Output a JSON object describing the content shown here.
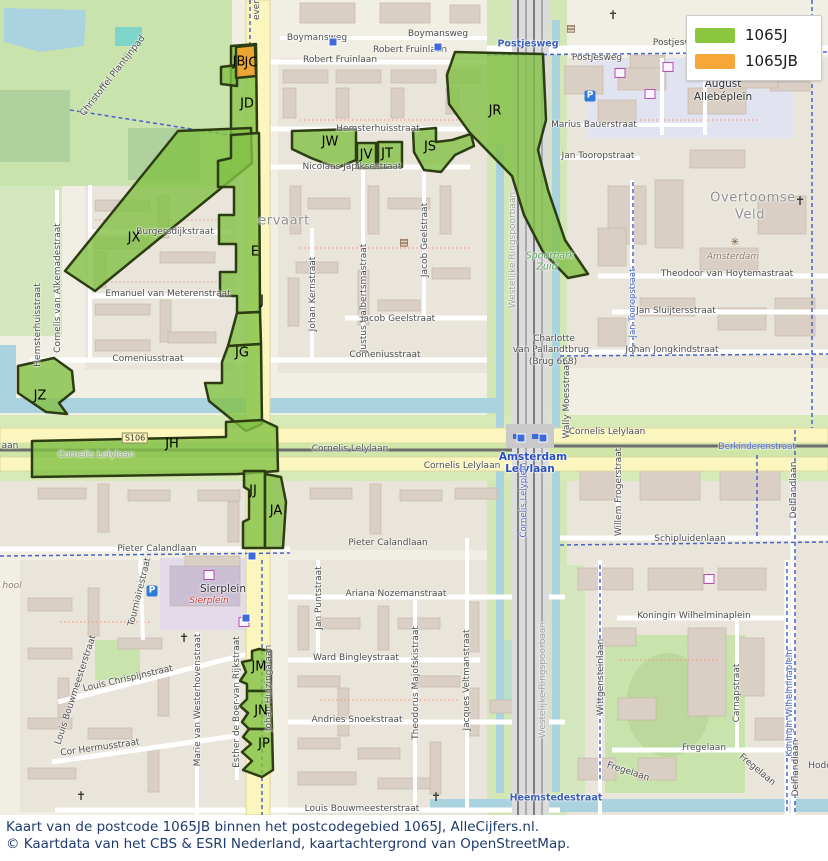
{
  "legend": {
    "items": [
      {
        "label": "1065J",
        "color": "#8cc63f"
      },
      {
        "label": "1065JB",
        "color": "#f7a738"
      }
    ]
  },
  "caption": {
    "line1": "Kaart van de postcode 1065JB binnen het postcodegebied 1065J, AlleCijfers.nl.",
    "line2": "© Kaartdata van het CBS & ESRI Nederland, kaartachtergrond van OpenStreetMap."
  },
  "colors": {
    "area_fill": "#82c045",
    "area_highlight_fill": "#f0a22e",
    "area_border": "#2c3d12",
    "water": "#aad3df",
    "park": "#c9e3ac",
    "road_yellow": "#fbf6bd",
    "caption_text": "#1e3c6e"
  },
  "map": {
    "area_code_labels": [
      {
        "text": "JB",
        "x": 239,
        "y": 62
      },
      {
        "text": "JC",
        "x": 251,
        "y": 63
      },
      {
        "text": "JD",
        "x": 247,
        "y": 104
      },
      {
        "text": "JX",
        "x": 134,
        "y": 238
      },
      {
        "text": "E",
        "x": 255,
        "y": 252
      },
      {
        "text": "J",
        "x": 262,
        "y": 301
      },
      {
        "text": "JG",
        "x": 242,
        "y": 353
      },
      {
        "text": "JZ",
        "x": 40,
        "y": 396
      },
      {
        "text": "JH",
        "x": 172,
        "y": 444
      },
      {
        "text": "JJ",
        "x": 253,
        "y": 491
      },
      {
        "text": "JA",
        "x": 276,
        "y": 511
      },
      {
        "text": "JR",
        "x": 495,
        "y": 111
      },
      {
        "text": "JW",
        "x": 330,
        "y": 142
      },
      {
        "text": "JV",
        "x": 366,
        "y": 155
      },
      {
        "text": "JT",
        "x": 387,
        "y": 154
      },
      {
        "text": "JS",
        "x": 430,
        "y": 147
      },
      {
        "text": "JM",
        "x": 259,
        "y": 667
      },
      {
        "text": "JN",
        "x": 261,
        "y": 711
      },
      {
        "text": "JP",
        "x": 264,
        "y": 744
      }
    ],
    "labels": [
      {
        "text": "ever",
        "x": 257,
        "y": 10,
        "rot": -90
      },
      {
        "text": "Boymansweg",
        "x": 317,
        "y": 38
      },
      {
        "text": "Boymansweg",
        "x": 438,
        "y": 34
      },
      {
        "text": "Robert Fruinlaan",
        "x": 410,
        "y": 50
      },
      {
        "text": "Robert Fruinlaan",
        "x": 340,
        "y": 60
      },
      {
        "text": "Postjesweg",
        "x": 528,
        "y": 44,
        "cls": "st-blue"
      },
      {
        "text": "Postjesweg",
        "x": 597,
        "y": 58
      },
      {
        "text": "Postjesweg",
        "x": 678,
        "y": 43
      },
      {
        "text": "F",
        "x": 810,
        "y": 29,
        "cls": "st-blue"
      },
      {
        "text": "August",
        "x": 723,
        "y": 84,
        "cls": "place-sm"
      },
      {
        "text": "Allebéplein",
        "x": 723,
        "y": 97,
        "cls": "place-sm"
      },
      {
        "text": "Marius Bauerstraat",
        "x": 594,
        "y": 125
      },
      {
        "text": "Jan Tooropstraat",
        "x": 598,
        "y": 156
      },
      {
        "text": "Overtoomse",
        "x": 753,
        "y": 198,
        "cls": "place"
      },
      {
        "text": "Veld",
        "x": 750,
        "y": 215,
        "cls": "place"
      },
      {
        "text": "Amsterdam",
        "x": 733,
        "y": 257,
        "cls": "place-brown"
      },
      {
        "text": "Theodoor van Hoytemastraat",
        "x": 727,
        "y": 274
      },
      {
        "text": "Jan Sluijtersstraat",
        "x": 676,
        "y": 311
      },
      {
        "text": "Johan Jongkindstraat",
        "x": 672,
        "y": 350
      },
      {
        "text": "Jan Tooropstraat",
        "x": 633,
        "y": 303,
        "rot": -90,
        "cls": "st-blue-sm"
      },
      {
        "text": "Hemsterhuisstraat",
        "x": 378,
        "y": 129
      },
      {
        "text": "Nicolaas Japiksestraat",
        "x": 352,
        "y": 167
      },
      {
        "text": "ervaart",
        "x": 284,
        "y": 221,
        "cls": "place"
      },
      {
        "text": "Burgersdijkstraat",
        "x": 175,
        "y": 232
      },
      {
        "text": "Emanuel van Meterenstraat",
        "x": 168,
        "y": 294
      },
      {
        "text": "Comeniusstraat",
        "x": 148,
        "y": 359
      },
      {
        "text": "Comeniusstraat",
        "x": 385,
        "y": 355
      },
      {
        "text": "Jacob Geelstraat",
        "x": 398,
        "y": 319
      },
      {
        "text": "Johan Kernstraat",
        "x": 313,
        "y": 294,
        "rot": -90
      },
      {
        "text": "Justus Halbertsmastraat",
        "x": 364,
        "y": 298,
        "rot": -90
      },
      {
        "text": "Jacob Geelstraat",
        "x": 425,
        "y": 240,
        "rot": -90
      },
      {
        "text": "Cornelis van Alkemadestraat",
        "x": 58,
        "y": 288,
        "rot": -90
      },
      {
        "text": "Hemsterhuisstraat",
        "x": 38,
        "y": 325,
        "rot": -90
      },
      {
        "text": "Christoffel Plantijnpad",
        "x": 113,
        "y": 76,
        "rot": -52
      },
      {
        "text": "Westelijke Ringspoorbaan",
        "x": 513,
        "y": 250,
        "rot": -90,
        "cls": "st-faded"
      },
      {
        "text": "Spoorpark",
        "x": 550,
        "y": 256,
        "cls": "park-lbl"
      },
      {
        "text": "Zuid",
        "x": 547,
        "y": 267,
        "cls": "park-lbl"
      },
      {
        "text": "Charlotte",
        "x": 554,
        "y": 339
      },
      {
        "text": "van Pallandtbrug",
        "x": 551,
        "y": 350
      },
      {
        "text": "(Brug 668)",
        "x": 553,
        "y": 362
      },
      {
        "text": "Wally Moesstraat",
        "x": 567,
        "y": 400,
        "rot": -90
      },
      {
        "text": "aan",
        "x": 10,
        "y": 446
      },
      {
        "text": "S106",
        "x": 135,
        "y": 438,
        "cls": "shield"
      },
      {
        "text": "Cornelis Lelylaan",
        "x": 96,
        "y": 455,
        "cls": "st-faded"
      },
      {
        "text": "Cornelis Lelylaan",
        "x": 350,
        "y": 449
      },
      {
        "text": "Cornelis Lelylaan",
        "x": 462,
        "y": 466
      },
      {
        "text": "Cornelis Lelylaan",
        "x": 607,
        "y": 432
      },
      {
        "text": "Amsterdam",
        "x": 533,
        "y": 457,
        "cls": "station"
      },
      {
        "text": "Lelylaan",
        "x": 530,
        "y": 469,
        "cls": "station"
      },
      {
        "text": "Cornelis Lelyplein",
        "x": 524,
        "y": 500,
        "rot": -90,
        "cls": "st-blue-sm"
      },
      {
        "text": "Derkinderenstraat",
        "x": 757,
        "y": 447,
        "cls": "st-blue-sm"
      },
      {
        "text": "Willem Frogerstraat",
        "x": 619,
        "y": 492,
        "rot": -90
      },
      {
        "text": "Delflandlaan",
        "x": 794,
        "y": 490,
        "rot": -90
      },
      {
        "text": "Schipluidenlaan",
        "x": 690,
        "y": 539
      },
      {
        "text": "Pieter Calandlaan",
        "x": 157,
        "y": 549
      },
      {
        "text": "Pieter Calandlaan",
        "x": 388,
        "y": 543
      },
      {
        "text": "Sierplein",
        "x": 223,
        "y": 589,
        "cls": "place-sm"
      },
      {
        "text": "Sierplein",
        "x": 209,
        "y": 601,
        "cls": "poi-red"
      },
      {
        "text": "hool",
        "x": 12,
        "y": 586,
        "cls": "place-brown"
      },
      {
        "text": "Tourniairestraat",
        "x": 140,
        "y": 592,
        "rot": -76
      },
      {
        "text": "Louis Bouwmeesterstraat",
        "x": 76,
        "y": 690,
        "rot": -72
      },
      {
        "text": "Louis Chrispijnstraat",
        "x": 128,
        "y": 679,
        "rot": -13
      },
      {
        "text": "Cor Hermusstraat",
        "x": 100,
        "y": 748,
        "rot": -8
      },
      {
        "text": "Marie van Westerhovenstraat",
        "x": 198,
        "y": 700,
        "rot": -90
      },
      {
        "text": "Esther de Boer-van Rijkstraat",
        "x": 237,
        "y": 702,
        "rot": -90
      },
      {
        "text": "Johan Huizingalaan",
        "x": 269,
        "y": 688,
        "rot": -90
      },
      {
        "text": "Jan Puntstraat",
        "x": 319,
        "y": 598,
        "rot": -90
      },
      {
        "text": "Ariana Nozemanstraat",
        "x": 396,
        "y": 594
      },
      {
        "text": "Ward Bingleystraat",
        "x": 356,
        "y": 658
      },
      {
        "text": "Andries Snoekstraat",
        "x": 357,
        "y": 720
      },
      {
        "text": "Theodorus Majofskistraat",
        "x": 416,
        "y": 683,
        "rot": -90
      },
      {
        "text": "Jacques Veltmanstraat",
        "x": 467,
        "y": 680,
        "rot": -90
      },
      {
        "text": "Louis Bouwmeesterstraat",
        "x": 362,
        "y": 809
      },
      {
        "text": "Westelijke Ringspoorbaan",
        "x": 543,
        "y": 680,
        "rot": -90,
        "cls": "st-faded"
      },
      {
        "text": "Heemstedestraat",
        "x": 556,
        "y": 798,
        "cls": "st-blue"
      },
      {
        "text": "Koningin Wilhelminaplein",
        "x": 694,
        "y": 616
      },
      {
        "text": "Wittgensteinlaan",
        "x": 601,
        "y": 677,
        "rot": -90
      },
      {
        "text": "Carnapstraat",
        "x": 737,
        "y": 693,
        "rot": -90
      },
      {
        "text": "Fregelaan",
        "x": 704,
        "y": 748
      },
      {
        "text": "Fregelaan",
        "x": 628,
        "y": 772,
        "rot": 18
      },
      {
        "text": "Fregelaan",
        "x": 757,
        "y": 770,
        "rot": 40
      },
      {
        "text": "Koningin Wilhelminaplein",
        "x": 790,
        "y": 703,
        "rot": -90,
        "cls": "st-blue-sm"
      },
      {
        "text": "Delflandlaan",
        "x": 796,
        "y": 768,
        "rot": -90
      },
      {
        "text": "Hode",
        "x": 820,
        "y": 766
      }
    ],
    "icons": [
      {
        "name": "church-icon",
        "x": 613,
        "y": 15,
        "g": "✝"
      },
      {
        "name": "church-icon",
        "x": 800,
        "y": 201,
        "g": "✝"
      },
      {
        "name": "church-icon",
        "x": 184,
        "y": 638,
        "g": "✝"
      },
      {
        "name": "church-icon",
        "x": 81,
        "y": 796,
        "g": "✝"
      },
      {
        "name": "church-icon",
        "x": 436,
        "y": 797,
        "g": "✝"
      },
      {
        "name": "mosque-icon",
        "x": 732,
        "y": 71,
        "g": "☪"
      },
      {
        "name": "library-icon",
        "x": 571,
        "y": 29,
        "g": "▤"
      },
      {
        "name": "library-icon",
        "x": 404,
        "y": 243,
        "g": "▤"
      },
      {
        "name": "asterisk-icon",
        "x": 735,
        "y": 242,
        "g": "✳"
      },
      {
        "name": "parking-icon",
        "x": 590,
        "y": 96,
        "g": "P"
      },
      {
        "name": "parking-icon",
        "x": 152,
        "y": 591,
        "g": "P"
      },
      {
        "name": "cart-icon",
        "x": 620,
        "y": 73,
        "g": ""
      },
      {
        "name": "cart-icon",
        "x": 668,
        "y": 67,
        "g": ""
      },
      {
        "name": "cart-icon",
        "x": 650,
        "y": 94,
        "g": ""
      },
      {
        "name": "cart-icon",
        "x": 209,
        "y": 575,
        "g": ""
      },
      {
        "name": "cart-icon",
        "x": 244,
        "y": 622,
        "g": ""
      },
      {
        "name": "cart-icon",
        "x": 709,
        "y": 579,
        "g": ""
      },
      {
        "name": "tram-stop-icon",
        "x": 333,
        "y": 42,
        "g": ""
      },
      {
        "name": "tram-stop-icon",
        "x": 438,
        "y": 47,
        "g": ""
      },
      {
        "name": "tram-stop-icon",
        "x": 521,
        "y": 438,
        "g": ""
      },
      {
        "name": "tram-stop-icon",
        "x": 543,
        "y": 438,
        "g": ""
      },
      {
        "name": "tram-stop-icon",
        "x": 252,
        "y": 556,
        "g": ""
      },
      {
        "name": "tram-stop-icon",
        "x": 246,
        "y": 618,
        "g": ""
      }
    ]
  }
}
